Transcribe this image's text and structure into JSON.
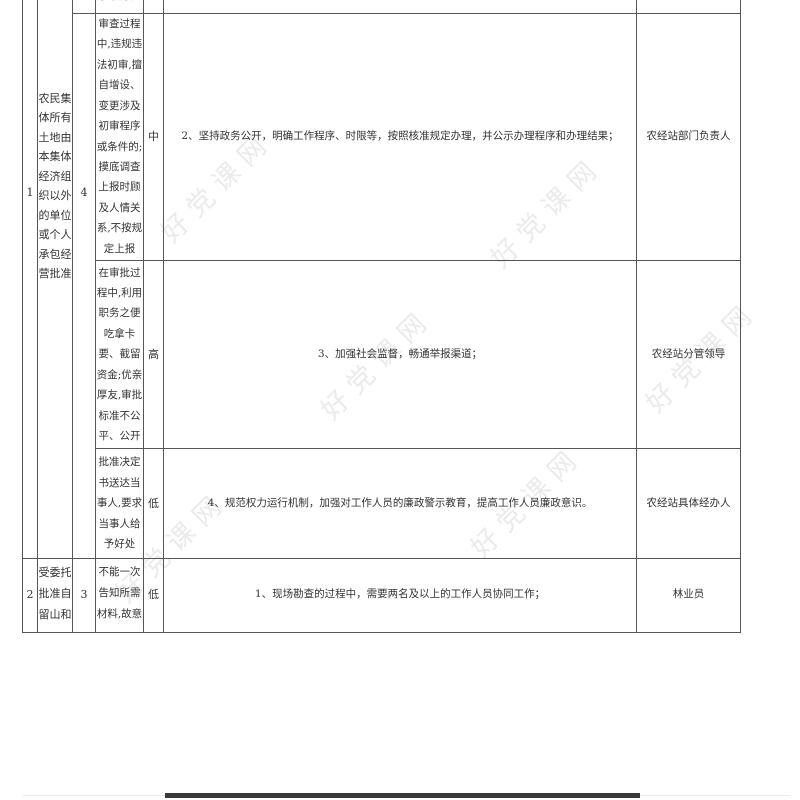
{
  "watermark": {
    "text": "好党课网",
    "color": "#ebebeb"
  },
  "colors": {
    "border": "#555555",
    "text": "#333333",
    "bottom_bar": "#3a3a3a"
  },
  "table": {
    "partial_top_cell": "索取好处",
    "blocks": [
      {
        "no": "1",
        "authority": "农民集体所有土地由本集体经济组织以外的单位或个人承包经营批准",
        "risk_no": "4",
        "rows": [
          {
            "risk": "审查过程中,违规违法初审,擅自增设、变更涉及初审程序或条件的;摸底调查上报时顾及人情关系,不按规定上报",
            "level": "中",
            "measure": "2、坚持政务公开，明确工作程序、时限等，按照核准规定办理，并公示办理程序和办理结果；",
            "responsible": "农经站部门负责人"
          },
          {
            "risk": "在审批过程中,利用职务之便吃拿卡要、截留资金;优亲厚友,审批标准不公平、公开",
            "level": "高",
            "measure": "3、加强社会监督，畅通举报渠道；",
            "responsible": "农经站分管领导"
          },
          {
            "risk": "批准决定书送达当事人,要求当事人给予好处",
            "level": "低",
            "measure": "4、规范权力运行机制，加强对工作人员的廉政警示教育，提高工作人员廉政意识。",
            "responsible": "农经站具体经办人"
          }
        ]
      },
      {
        "no": "2",
        "authority": "受委托批准自留山和",
        "risk_no": "3",
        "rows": [
          {
            "risk": "不能一次告知所需材料,故意",
            "level": "低",
            "measure": "1、现场勘查的过程中，需要两名及以上的工作人员协同工作；",
            "responsible": "林业员"
          }
        ]
      }
    ]
  }
}
